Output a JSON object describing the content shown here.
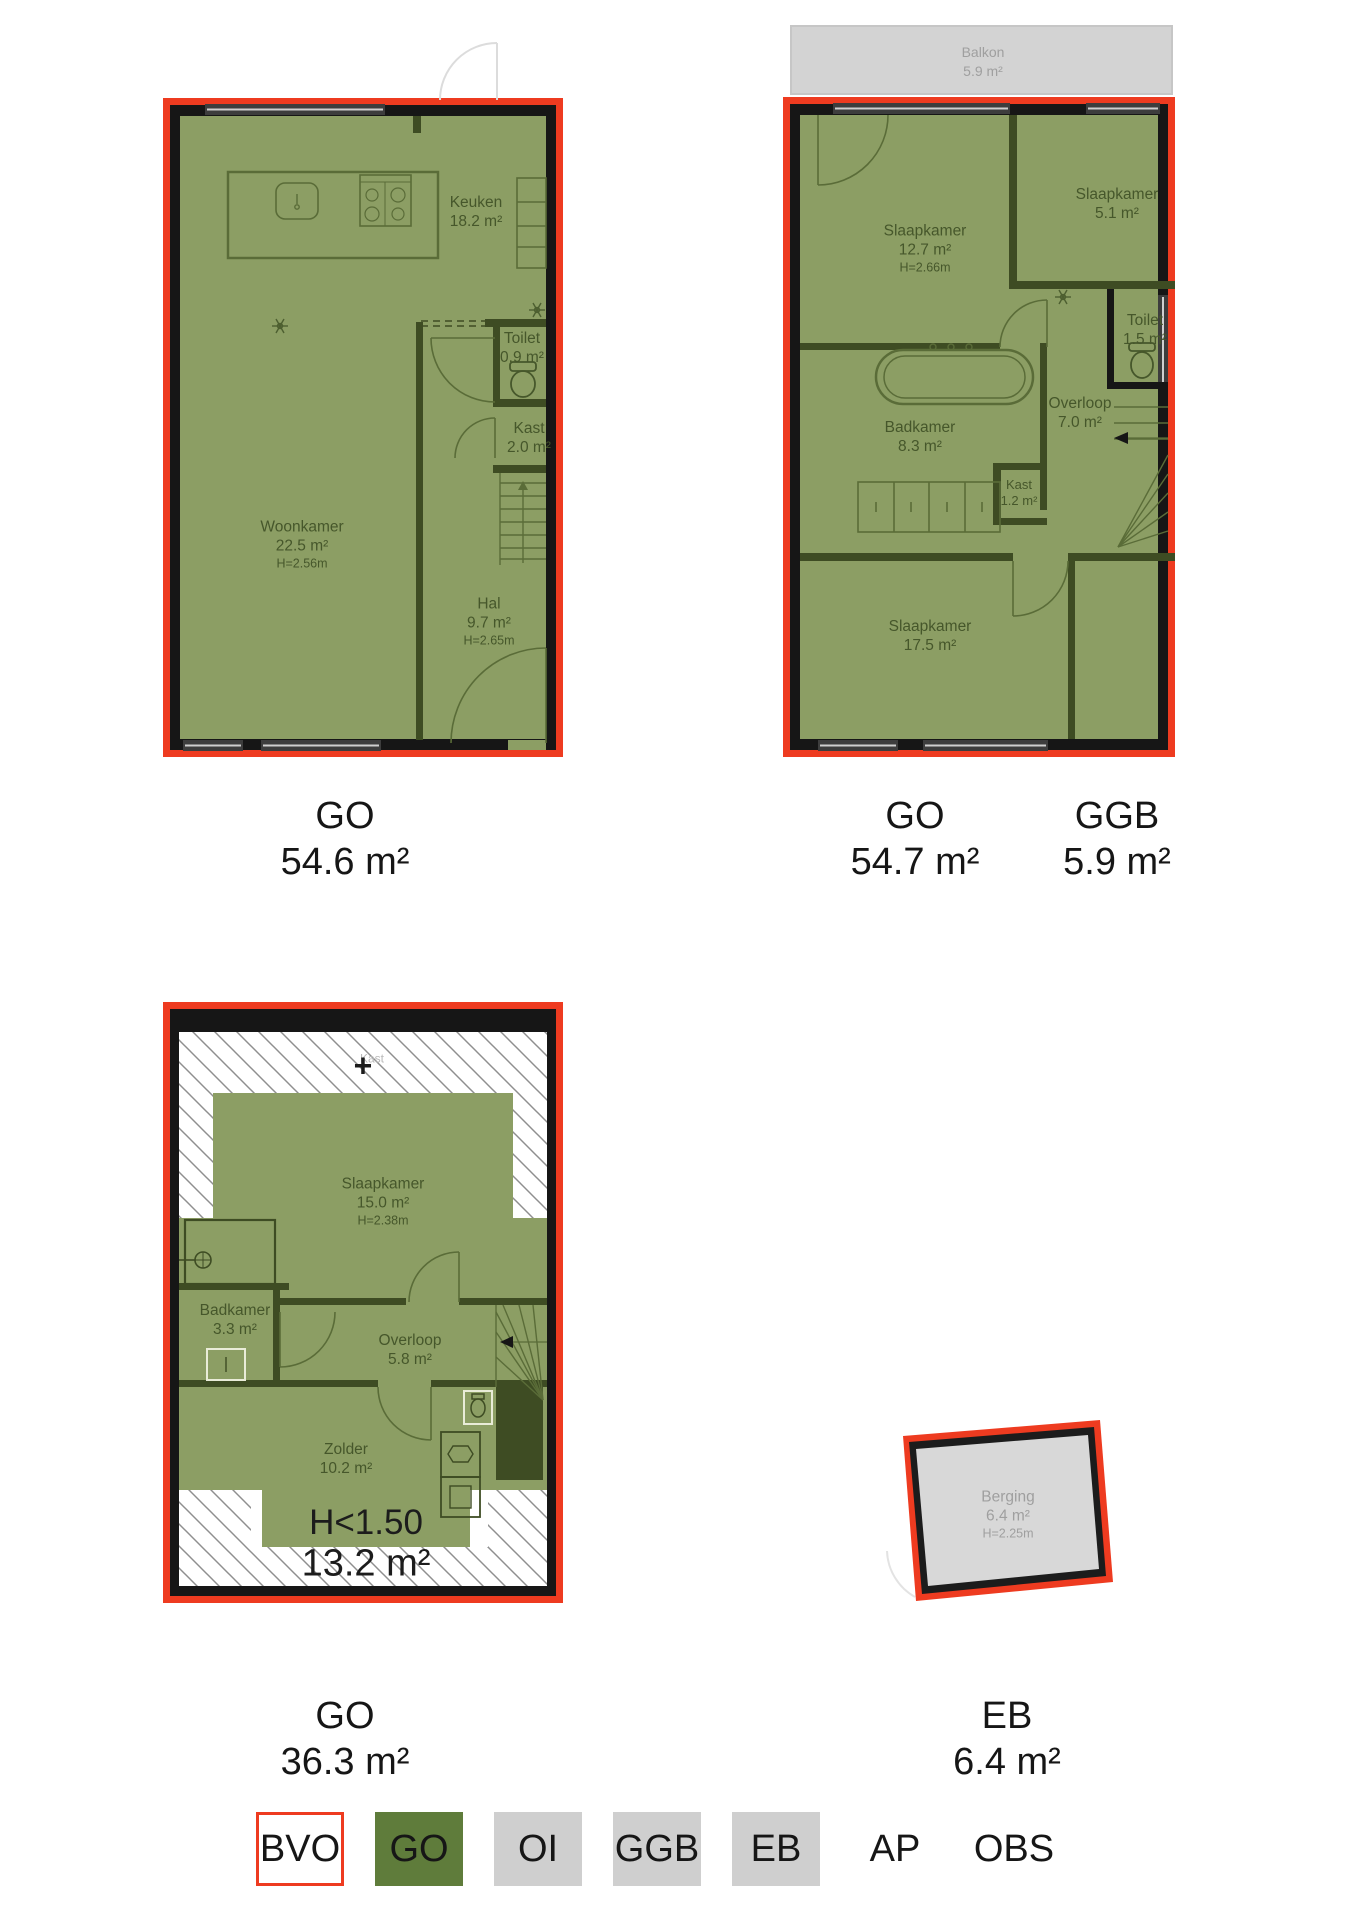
{
  "colors": {
    "outline_red": "#ee3b20",
    "wall_black": "#161616",
    "go_fill": "#8c9e64",
    "go_wall_dark": "#3e4c23",
    "legend_green": "#5f7c3b",
    "grey_fill": "#d2d2d2",
    "grey_text": "#9f9f9f",
    "room_text": "#46572b"
  },
  "floor1": {
    "rooms": {
      "keuken": {
        "name": "Keuken",
        "area": "18.2 m²"
      },
      "woonkamer": {
        "name": "Woonkamer",
        "area": "22.5 m²",
        "height": "H=2.56m"
      },
      "toilet": {
        "name": "Toilet",
        "area": "0.9 m²"
      },
      "kast": {
        "name": "Kast",
        "area": "2.0 m²"
      },
      "hal": {
        "name": "Hal",
        "area": "9.7 m²",
        "height": "H=2.65m"
      }
    },
    "captions": [
      {
        "code": "GO",
        "value": "54.6 m²"
      }
    ]
  },
  "floor2": {
    "rooms": {
      "balkon": {
        "name": "Balkon",
        "area": "5.9 m²"
      },
      "slaapkamer1": {
        "name": "Slaapkamer",
        "area": "12.7 m²",
        "height": "H=2.66m"
      },
      "slaapkamer2": {
        "name": "Slaapkamer",
        "area": "5.1 m²"
      },
      "toilet": {
        "name": "Toilet",
        "area": "1.5 m²"
      },
      "overloop": {
        "name": "Overloop",
        "area": "7.0 m²"
      },
      "badkamer": {
        "name": "Badkamer",
        "area": "8.3 m²"
      },
      "kast": {
        "name": "Kast",
        "area": "1.2 m²"
      },
      "slaapkamer3": {
        "name": "Slaapkamer",
        "area": "17.5 m²"
      }
    },
    "captions": [
      {
        "code": "GO",
        "value": "54.7 m²"
      },
      {
        "code": "GGB",
        "value": "5.9 m²"
      }
    ]
  },
  "floor3": {
    "rooms": {
      "slaapkamer": {
        "name": "Slaapkamer",
        "area": "15.0 m²",
        "height": "H=2.38m"
      },
      "badkamer": {
        "name": "Badkamer",
        "area": "3.3 m²"
      },
      "overloop": {
        "name": "Overloop",
        "area": "5.8 m²"
      },
      "zolder": {
        "name": "Zolder",
        "area": "10.2 m²"
      },
      "kast_attic": {
        "name": "Kast"
      }
    },
    "annotations": {
      "plus": "+",
      "low_height": "H<1.50",
      "low_height_area": "13.2 m²"
    },
    "captions": [
      {
        "code": "GO",
        "value": "36.3 m²"
      }
    ]
  },
  "berging": {
    "rooms": {
      "berging": {
        "name": "Berging",
        "area": "6.4 m²",
        "height": "H=2.25m"
      }
    },
    "captions": [
      {
        "code": "EB",
        "value": "6.4 m²"
      }
    ]
  },
  "legend": {
    "items": [
      {
        "label": "BVO",
        "style": "bvo"
      },
      {
        "label": "GO",
        "style": "go"
      },
      {
        "label": "OI",
        "style": "grey"
      },
      {
        "label": "GGB",
        "style": "grey"
      },
      {
        "label": "EB",
        "style": "grey"
      },
      {
        "label": "AP",
        "style": "plain"
      },
      {
        "label": "OBS",
        "style": "plain"
      }
    ]
  }
}
